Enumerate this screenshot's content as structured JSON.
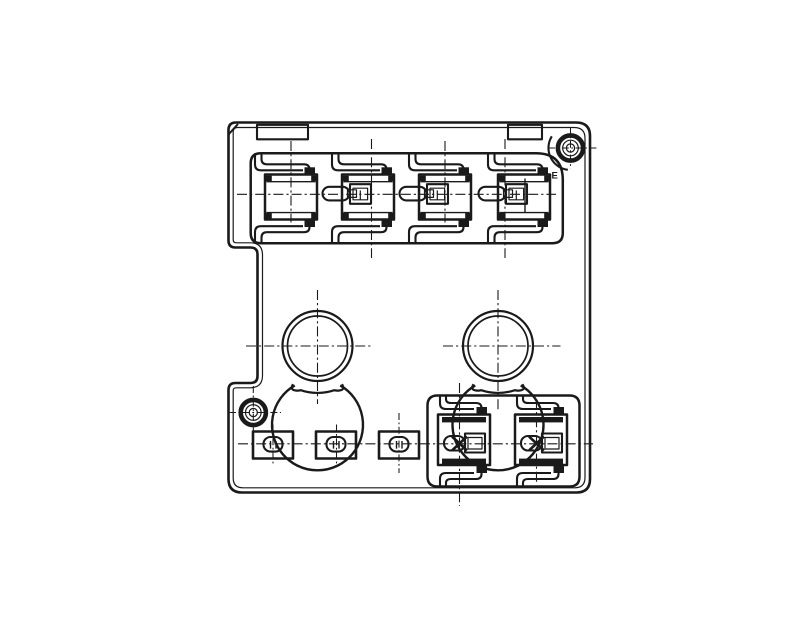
{
  "canvas": {
    "width": 800,
    "height": 630,
    "background": "#ffffff",
    "line_color": "#1a1a1a"
  },
  "labels": {
    "cavity_marking": "E"
  }
}
